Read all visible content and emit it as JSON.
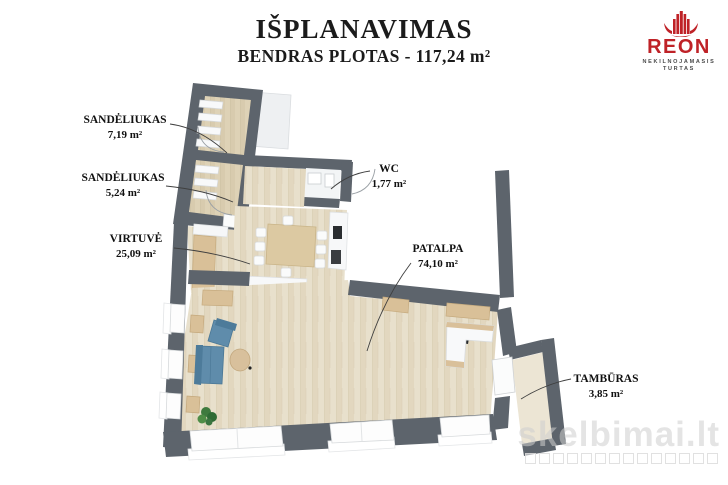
{
  "header": {
    "title": "IŠPLANAVIMAS",
    "subtitle": "BENDRAS PLOTAS - 117,24 m²"
  },
  "logo": {
    "name": "REON",
    "tagline_line1": "NEKILNOJAMASIS",
    "tagline_line2": "TURTAS",
    "color": "#bf2227"
  },
  "floorplan": {
    "rooms": [
      {
        "id": "sandeliukas-1",
        "name": "SANDĖLIUKAS",
        "area": "7,19 m²"
      },
      {
        "id": "sandeliukas-2",
        "name": "SANDĖLIUKAS",
        "area": "5,24 m²"
      },
      {
        "id": "virtuve",
        "name": "VIRTUVĖ",
        "area": "25,09 m²"
      },
      {
        "id": "wc",
        "name": "WC",
        "area": "1,77 m²"
      },
      {
        "id": "patalpa",
        "name": "PATALPA",
        "area": "74,10 m²"
      },
      {
        "id": "tamburas",
        "name": "TAMBŪRAS",
        "area": "3,85 m²"
      }
    ],
    "colors": {
      "wall": "#5d646c",
      "wood_floor": "#e7dfcb",
      "furniture_wood": "#d9c098",
      "sofa_blue": "#5f8cab"
    }
  },
  "watermark": {
    "text": "skelbimai.lt"
  }
}
